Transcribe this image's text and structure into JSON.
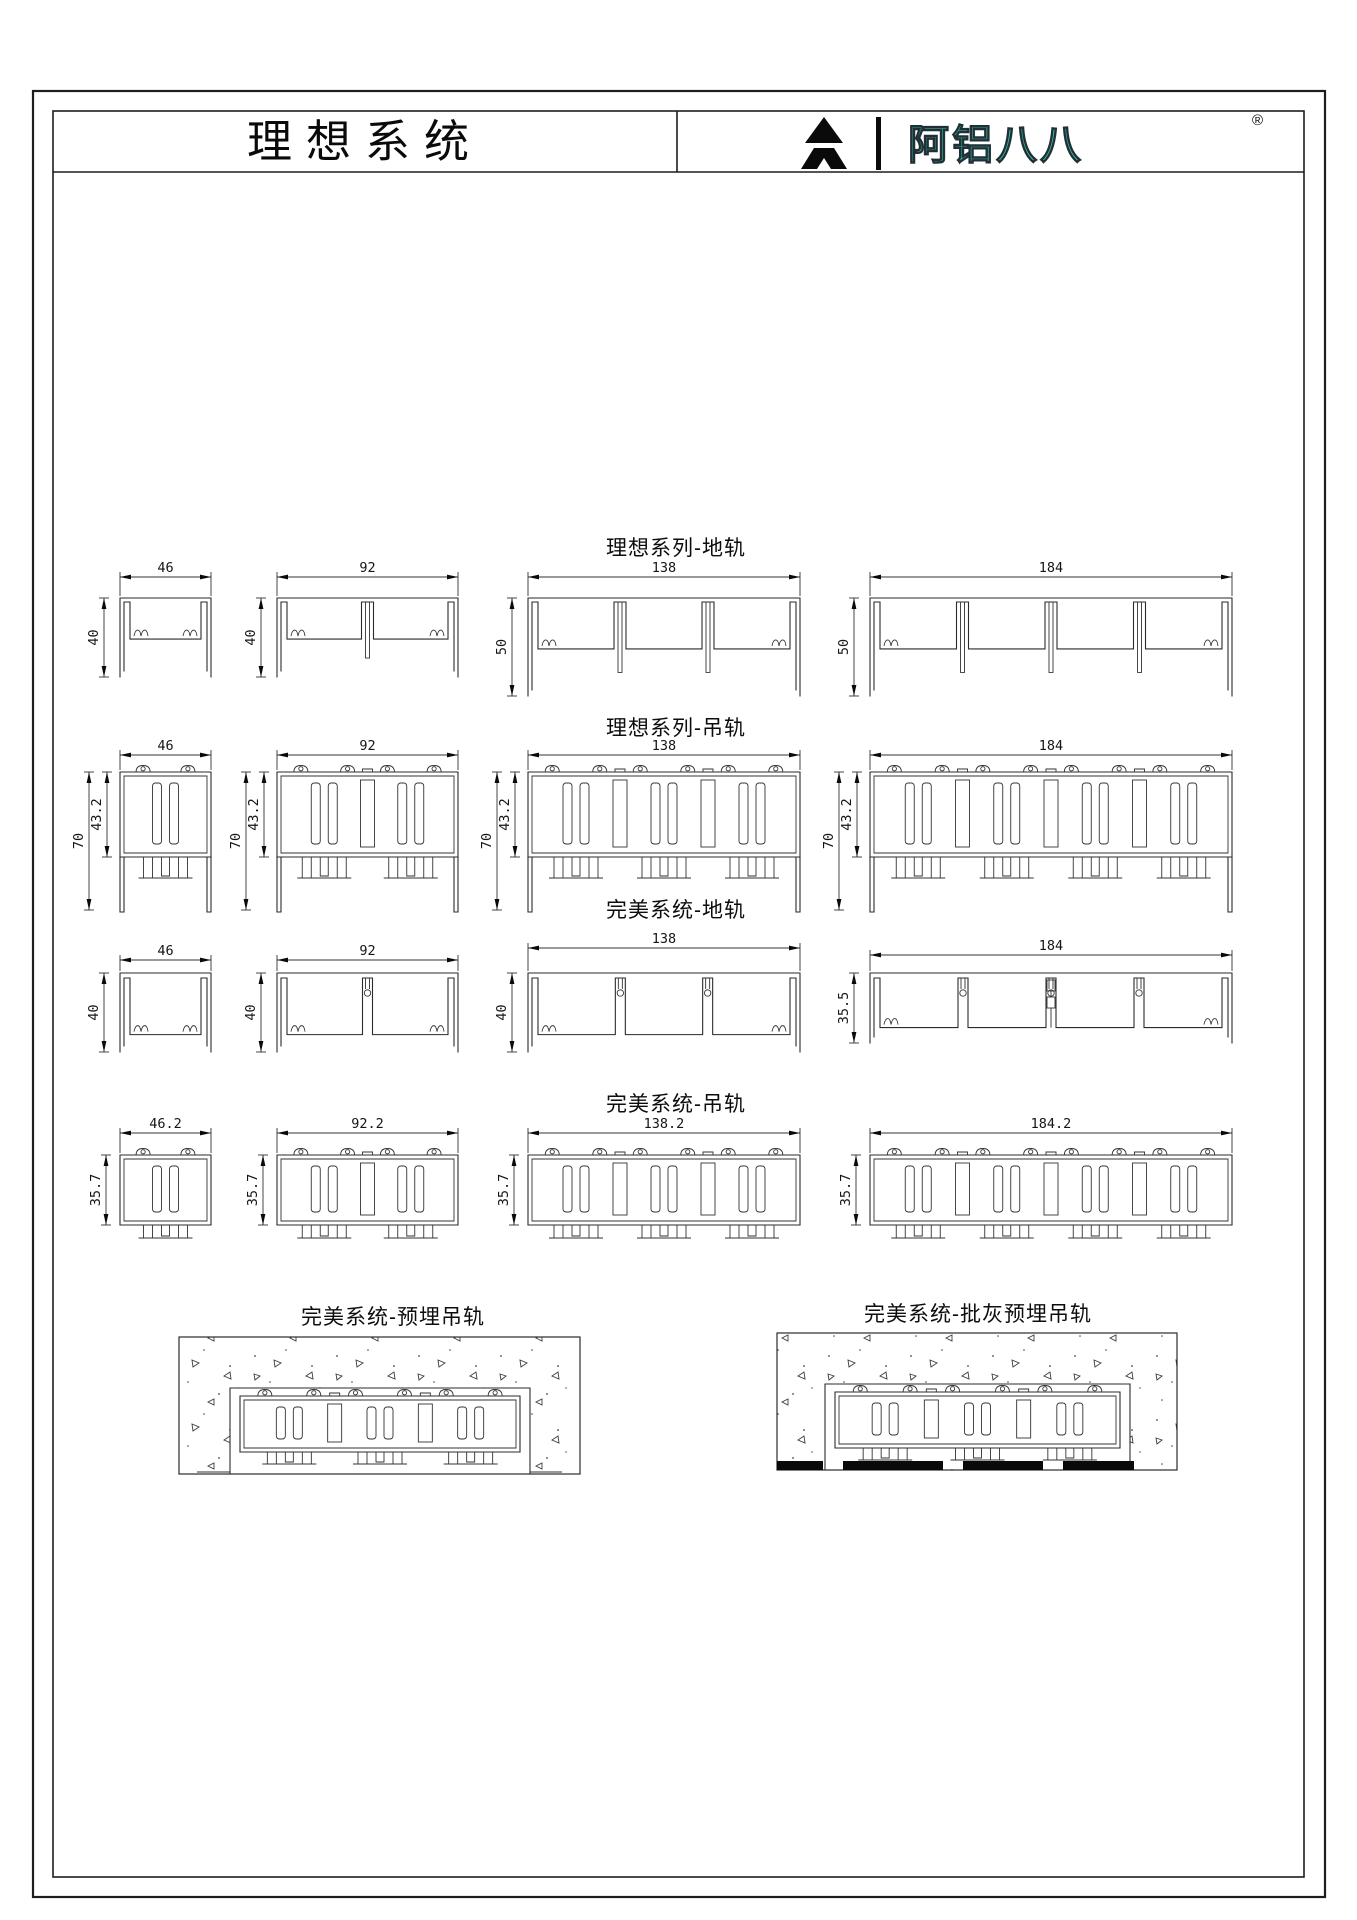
{
  "header": {
    "doc_title": "理想系统",
    "brand": {
      "name": "阿铝八八",
      "registered": "®",
      "color": "#3BC9A4",
      "mark": "stylized-A-triangle"
    }
  },
  "sections": [
    {
      "title": "理想系列-地轨",
      "type": "floor-track",
      "profiles": [
        {
          "width": "46",
          "height": "40"
        },
        {
          "width": "92",
          "height": "40"
        },
        {
          "width": "138",
          "height": "50"
        },
        {
          "width": "184",
          "height": "50"
        }
      ]
    },
    {
      "title": "理想系列-吊轨",
      "type": "hanging-track",
      "profiles": [
        {
          "width": "46",
          "height": "70",
          "height2": "43.2"
        },
        {
          "width": "92",
          "height": "70",
          "height2": "43.2"
        },
        {
          "width": "138",
          "height": "70",
          "height2": "43.2"
        },
        {
          "width": "184",
          "height": "70",
          "height2": "43.2"
        }
      ]
    },
    {
      "title": "完美系统-地轨",
      "type": "floor-track",
      "profiles": [
        {
          "width": "46",
          "height": "40"
        },
        {
          "width": "92",
          "height": "40"
        },
        {
          "width": "138",
          "height": "40"
        },
        {
          "width": "184",
          "height": "35.5"
        }
      ]
    },
    {
      "title": "完美系统-吊轨",
      "type": "hanging-track",
      "profiles": [
        {
          "width": "46.2",
          "height": "35.7"
        },
        {
          "width": "92.2",
          "height": "35.7"
        },
        {
          "width": "138.2",
          "height": "35.7"
        },
        {
          "width": "184.2",
          "height": "35.7"
        }
      ]
    }
  ],
  "embedded": [
    {
      "title": "完美系统-预埋吊轨"
    },
    {
      "title": "完美系统-批灰预埋吊轨"
    }
  ]
}
